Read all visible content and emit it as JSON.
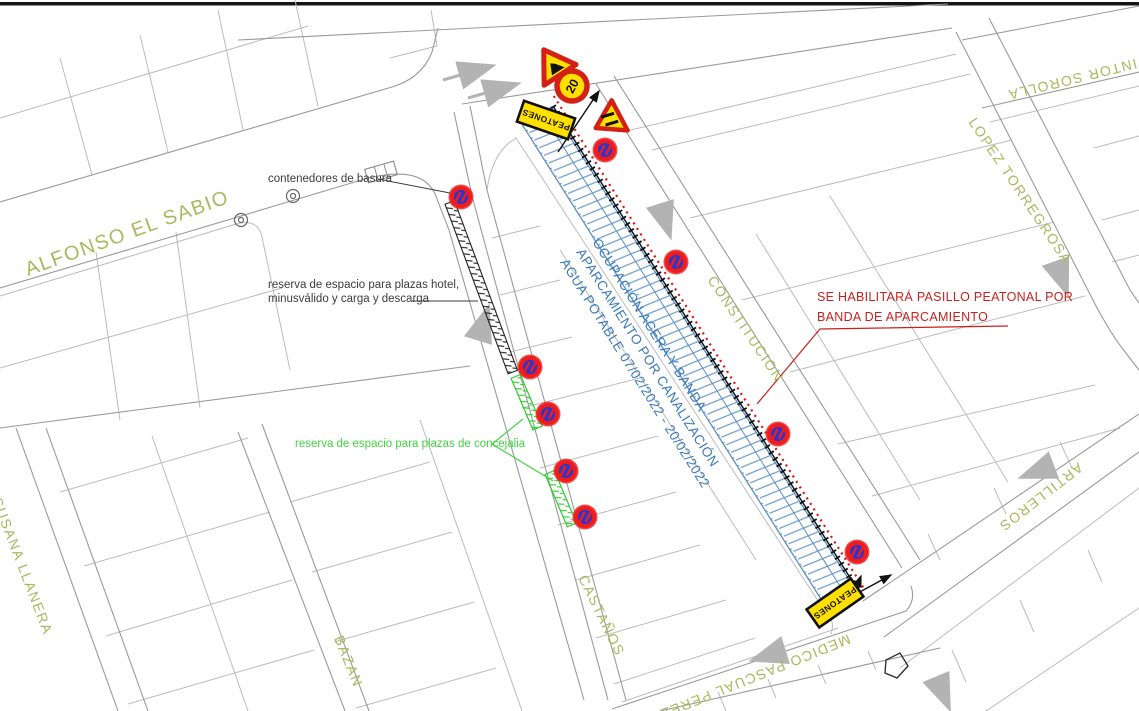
{
  "street_labels": {
    "alfonso": "ALFONSO EL SABIO",
    "susana": "SUSANA LLANERA",
    "bazan": "BAZAN",
    "castanos": "CASTAÑOS",
    "constitucion": "CONSTITUCION",
    "lopez": "LOPEZ TORREGROSA",
    "pintor": "PINTOR SOROLLA",
    "artilleros": "ARTILLEROS",
    "medico": "MEDICO PASCUAL PEREZ"
  },
  "annotations": {
    "contenedores": "contenedores de basura",
    "reserva_hotel_1": "reserva de espacio para plazas hotel,",
    "reserva_hotel_2": "minusválido y carga y descarga",
    "reserva_concejalia": "reserva de espacio para plazas de concejalia",
    "pasillo_1": "SE HABILITARÁ PASILLO PEATONAL POR",
    "pasillo_2": "BANDA DE APARCAMIENTO",
    "ocupacion_1": "OCUPACIÓN ACERA Y BANDA",
    "ocupacion_2": "APARCAMIENTO POR CANALIZACIÓN",
    "ocupacion_3": "AGUA POTABLE 07/02/2022 - 20/02/2022"
  },
  "signs": {
    "peatones_top": "PEATONES",
    "peatones_bottom": "PEATONES",
    "speed_limit": "20"
  },
  "colors": {
    "street_label_olive": "#a9b85e",
    "occupation_blue": "#3a7abd",
    "alert_red": "#c9201d",
    "reserve_green": "#3fd43f",
    "sign_yellow": "#ffe000",
    "sign_border_red": "#d42015",
    "no_parking_blue": "#2d35c8"
  }
}
